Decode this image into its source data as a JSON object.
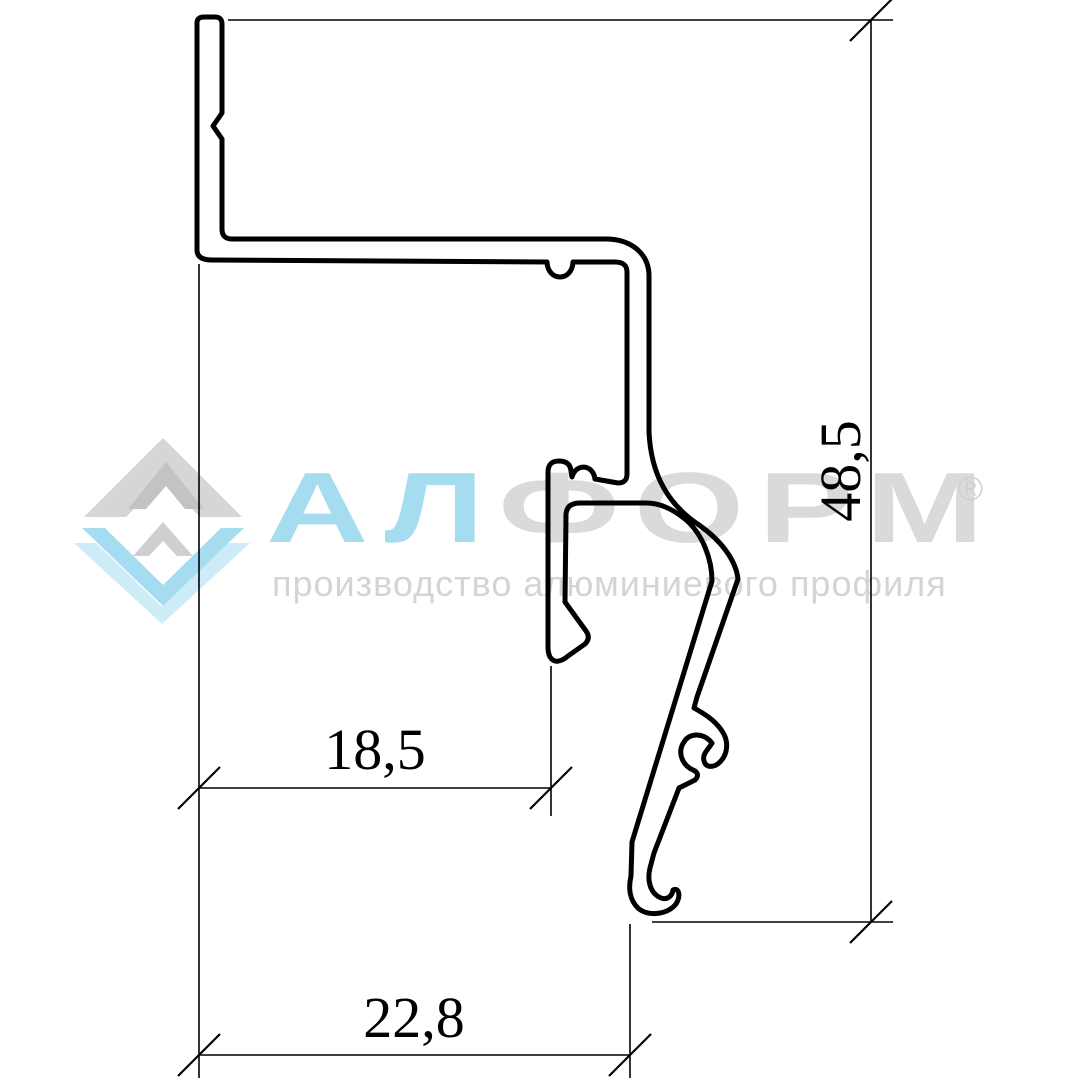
{
  "dimensions": {
    "top_width_label": "18,5",
    "bottom_width_label": "22,8",
    "height_label": "48,5"
  },
  "drawing": {
    "stroke_color": "#000000",
    "style": "aluminum profile cross-section, outline only"
  },
  "watermark": {
    "brand_blue_part": "АЛ",
    "brand_gray_part": "ФОРМ",
    "registered_mark": "®",
    "tagline": "производство алюминиевого профиля",
    "colors": {
      "logo_blue": "#a6dcf0",
      "logo_blue_light": "#cdecf8",
      "logo_gray": "#d6d6d8",
      "logo_gray_dark": "#c3c3c5",
      "brand_gray_text": "#dadadc",
      "tagline_gray": "#d4d4d6"
    }
  }
}
